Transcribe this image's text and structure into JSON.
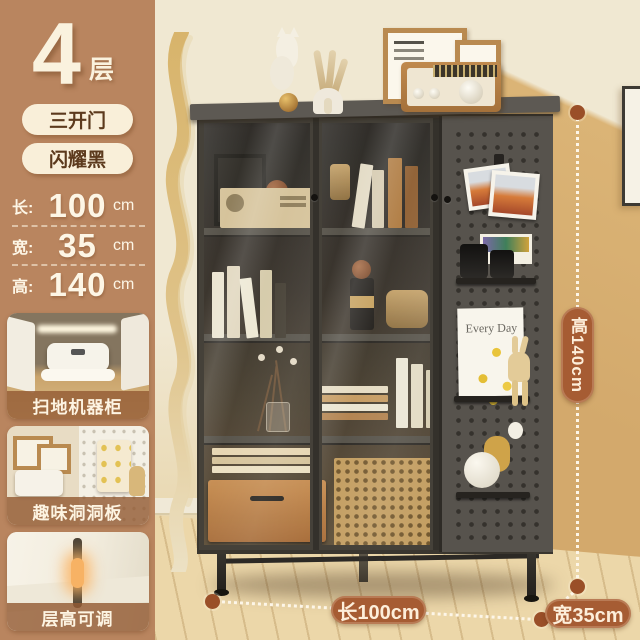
{
  "sidebar": {
    "tier_number": "4",
    "tier_unit": "层",
    "tags": [
      {
        "label": "三开门"
      },
      {
        "label": "闪耀黑"
      }
    ],
    "dims": [
      {
        "label": "长:",
        "value": "100",
        "unit": "cm"
      },
      {
        "label": "宽:",
        "value": "35",
        "unit": "cm"
      },
      {
        "label": "高:",
        "value": "140",
        "unit": "cm"
      }
    ],
    "features": [
      {
        "caption": "扫地机器柜"
      },
      {
        "caption": "趣味洞洞板"
      },
      {
        "caption": "层高可调"
      }
    ]
  },
  "photo": {
    "annotations": {
      "height_label": "高140cm",
      "length_label": "长100cm",
      "width_label": "宽35cm"
    },
    "pegboard_book_title": "Every Day"
  },
  "colors": {
    "sidebar_bg": "#b9855f",
    "tag_bg": "#f9efd9",
    "tag_text": "#5c3a1d",
    "annotation_pill": "#a65c33",
    "cabinet_body": "#57534d",
    "wall": "#f0e8d2",
    "wall_shadow": "#dbb476",
    "floor": "#ecd7a9"
  }
}
